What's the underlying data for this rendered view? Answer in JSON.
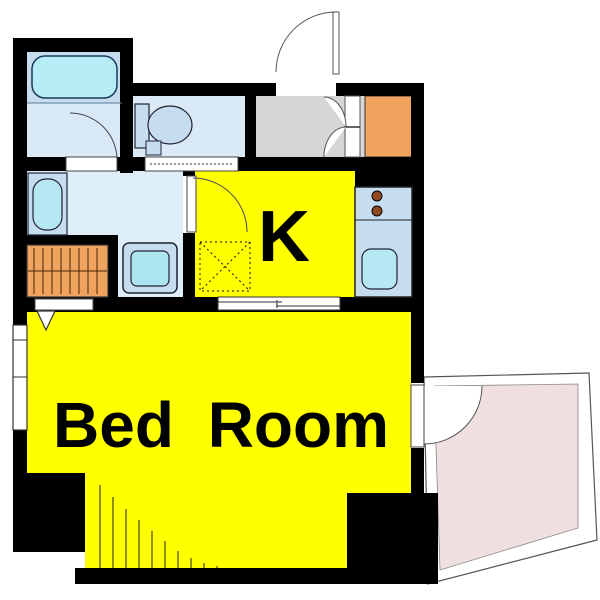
{
  "plan": {
    "type": "apartment-floor-plan",
    "labels": {
      "kitchen": "K",
      "bedroom": "Bed Room"
    },
    "rooms": [
      {
        "name": "bathroom",
        "fixtures": [
          "bathtub",
          "bath-door"
        ]
      },
      {
        "name": "toilet-room",
        "fixtures": [
          "toilet",
          "sliding-door"
        ]
      },
      {
        "name": "entrance-hall",
        "fixtures": [
          "entry-door",
          "double-closet-doors",
          "shoe-cabinet"
        ]
      },
      {
        "name": "washroom",
        "fixtures": [
          "vanity-sink",
          "washing-machine",
          "closet"
        ]
      },
      {
        "name": "kitchen",
        "fixtures": [
          "counter",
          "stove-burners",
          "kitchen-sink",
          "refrigerator-space",
          "hinged-door",
          "sliding-door"
        ]
      },
      {
        "name": "bedroom",
        "fixtures": [
          "window",
          "folding-closet-door",
          "balcony-door"
        ]
      },
      {
        "name": "balcony",
        "fixtures": []
      }
    ]
  },
  "colors": {
    "wall": "#000000",
    "room_yellow": "#ffff00",
    "bathroom_upper": "#c6ddee",
    "floor_blue": "#d9e9f6",
    "washroom_floor": "#ddeef8",
    "entrance_gray": "#d6d6d6",
    "cabinet_orange": "#f0a35e",
    "fixture_blue": "#c6ddf0",
    "tub_cyan": "#b6ecf4",
    "sink_cyan": "#b5e8f2",
    "washer_inner": "#ace4f0",
    "balcony_pink": "#f0dfdf",
    "burner_brown": "#8f4a20",
    "door_white": "#ffffff"
  }
}
